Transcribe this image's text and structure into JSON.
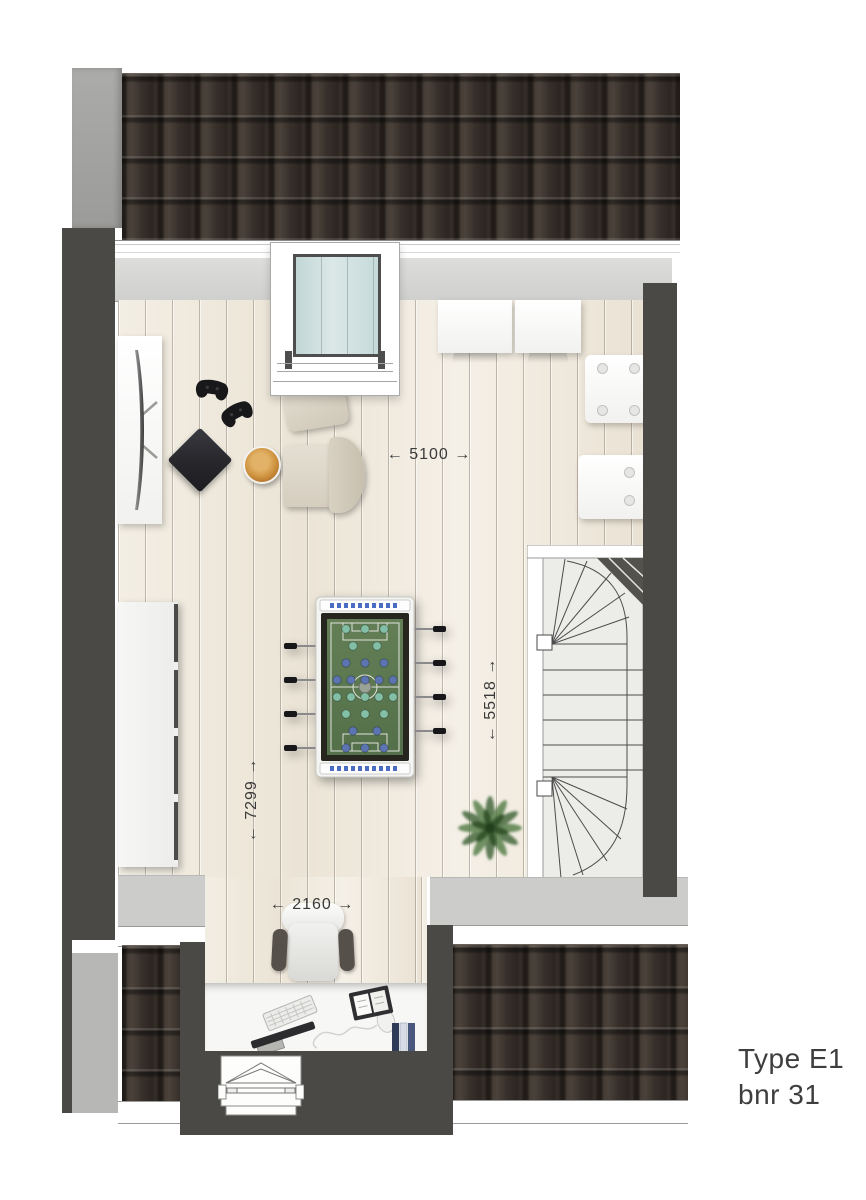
{
  "plan": {
    "type_label": {
      "line1": "Type E1",
      "line2": "bnr 31"
    },
    "dimensions": {
      "living_width": {
        "label": "← 5100 →",
        "value_mm": "5100",
        "orientation": "horizontal"
      },
      "stair_zone_depth": {
        "label": "← 5518 →",
        "value_mm": "5518",
        "orientation": "vertical"
      },
      "room_length": {
        "label": "← 7299 →",
        "value_mm": "7299",
        "orientation": "vertical"
      },
      "desk_nook_width": {
        "label": "← 2160 →",
        "value_mm": "2160",
        "orientation": "horizontal"
      }
    },
    "icons": [
      "tv-icon",
      "game-console-icon",
      "gamepad-icon",
      "snack-bowl-icon",
      "foosball-table-icon",
      "plant-icon",
      "office-chair-icon",
      "keyboard-icon",
      "mouse-icon",
      "monitor-icon",
      "notebook-icon",
      "file-folders-icon",
      "staircase-icon",
      "dormer-window-icon"
    ],
    "colors": {
      "wall_dark": "#4a4945",
      "roof_tiles": "#332d28",
      "eaves_gray": "#d5d5d3",
      "floor_wood": "#f1ebdf",
      "glass_blue": "#c9dcdb",
      "field_green": "#5d7b52",
      "team_teal": "#82bfa6",
      "team_blue": "#5c74b0",
      "text": "#3d3d3d"
    }
  }
}
